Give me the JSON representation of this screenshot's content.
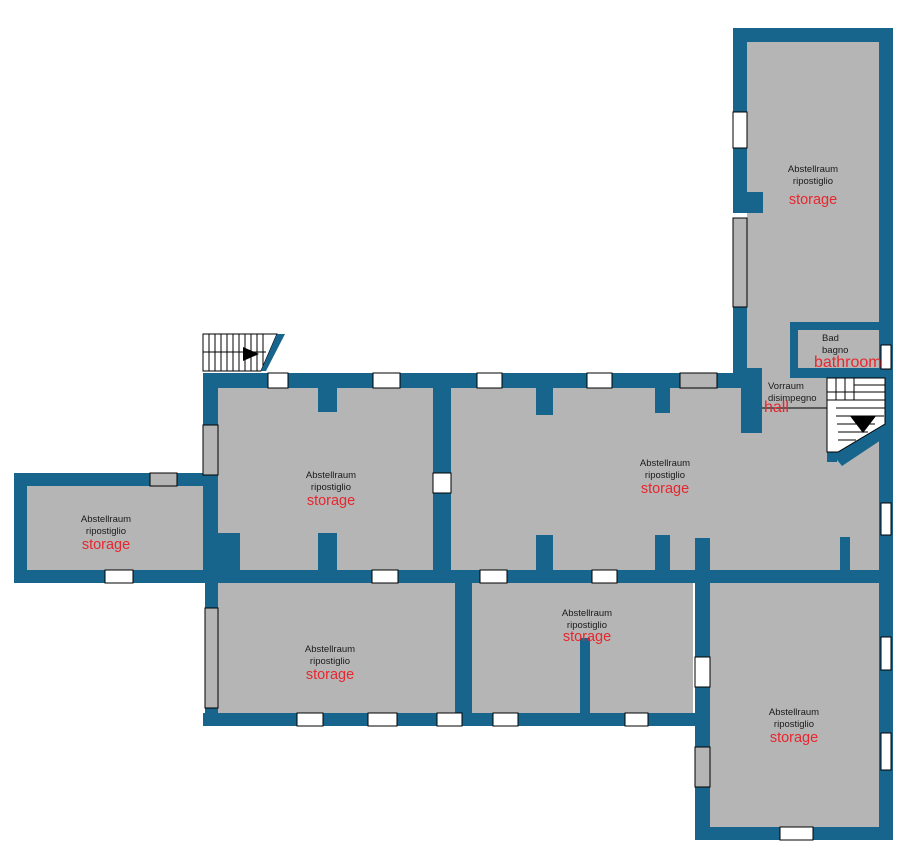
{
  "palette": {
    "wall": "#17648D",
    "floor": "#b5b5b5",
    "window": "#ffffff",
    "opening": "#b5b5b5",
    "label": "#1a1a1a",
    "highlight": "#e8262d",
    "outline": "#000000"
  },
  "rooms": {
    "storage_top_right": {
      "name_de": "Abstellraum",
      "name_it": "ripostiglio",
      "name_en": "storage"
    },
    "bathroom": {
      "name_de": "Bad",
      "name_it": "bagno",
      "name_en": "bathroom"
    },
    "hall": {
      "name_de": "Vorraum",
      "name_it": "disimpegno",
      "name_en": "hall"
    },
    "storage_main_left": {
      "name_de": "Abstellraum",
      "name_it": "ripostiglio",
      "name_en": "storage"
    },
    "storage_main_right": {
      "name_de": "Abstellraum",
      "name_it": "ripostiglio",
      "name_en": "storage"
    },
    "storage_west": {
      "name_de": "Abstellraum",
      "name_it": "ripostiglio",
      "name_en": "storage"
    },
    "storage_bottom_left": {
      "name_de": "Abstellraum",
      "name_it": "ripostiglio",
      "name_en": "storage"
    },
    "storage_bottom_center": {
      "name_de": "Abstellraum",
      "name_it": "ripostiglio",
      "name_en": "storage"
    },
    "storage_bottom_right": {
      "name_de": "Abstellraum",
      "name_it": "ripostiglio",
      "name_en": "storage"
    }
  }
}
